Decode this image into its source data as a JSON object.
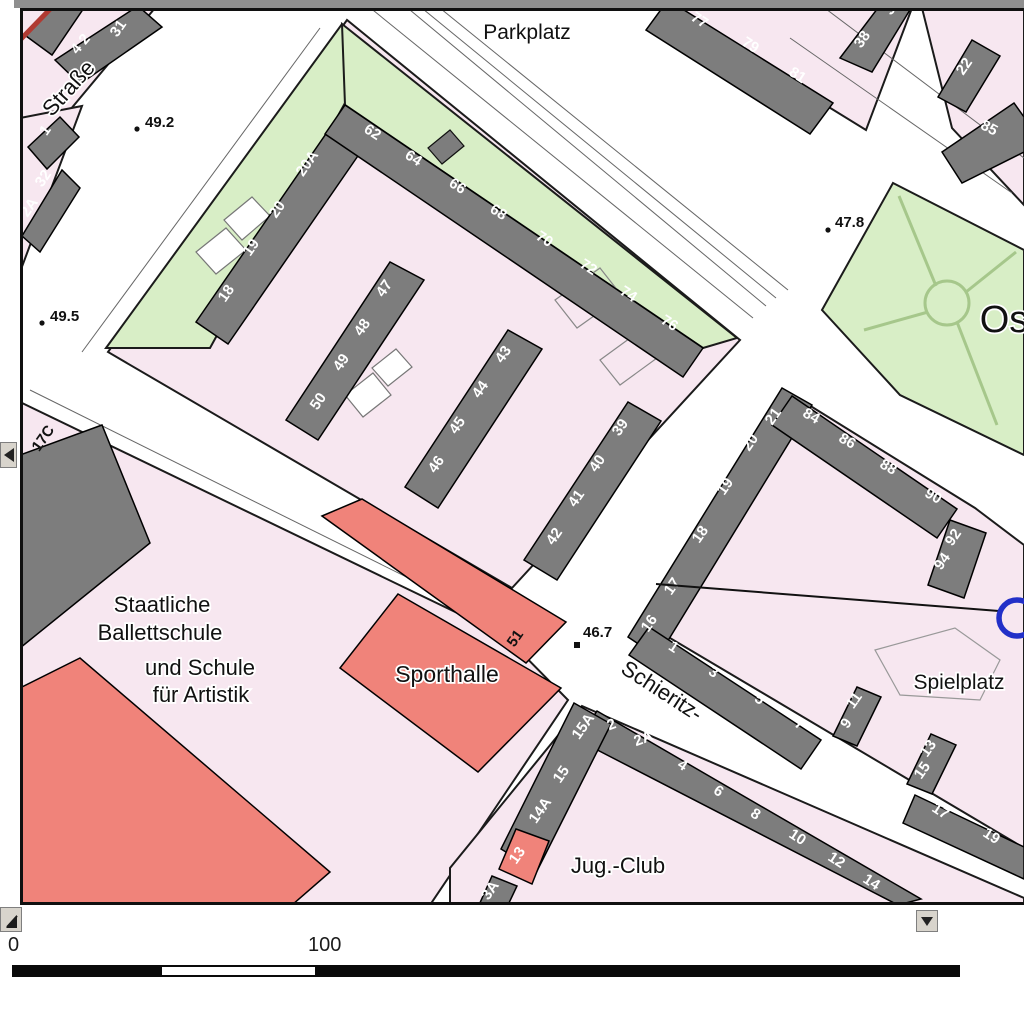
{
  "ui": {
    "scale": {
      "zero": "0",
      "hundred": "100"
    }
  },
  "colors": {
    "pink": "#f7e7f0",
    "green": "#d8eec6",
    "building": "#7d7d7d",
    "red": "#f0837a",
    "outline": "#1b1b1b",
    "park_path": "#a6c78b",
    "street_line": "#666666",
    "label_ink": "#111111",
    "halo": "#ffffff",
    "number_ink": "#ffffff",
    "annotation_blue": "#2230c8",
    "annotation_red": "#b03a32"
  },
  "map": {
    "blocks": [
      {
        "n": "block-topleft-a",
        "f": "pink",
        "p": "20,8 155,8 20,170"
      },
      {
        "n": "block-topleft-b",
        "f": "pink",
        "p": "20,118 82,106 20,272"
      },
      {
        "n": "block-main",
        "f": "pink",
        "p": "108,352 347,20 740,340 512,588"
      },
      {
        "n": "green-northwest",
        "f": "green",
        "p": "106,348 342,24 372,54 210,348"
      },
      {
        "n": "green-northeast",
        "f": "green",
        "p": "342,24 737,338 703,348 345,105"
      },
      {
        "n": "block-topright-a",
        "f": "pink",
        "p": "655,0 915,0 866,130"
      },
      {
        "n": "block-topright-b",
        "f": "pink",
        "p": "920,0 1024,0 1024,205 952,128"
      },
      {
        "n": "park-green",
        "f": "green",
        "p": "893,183 1024,250 1024,455 900,395 822,310"
      },
      {
        "n": "block-school",
        "f": "pink",
        "p": "20,402 505,636 568,700 430,905 20,905"
      },
      {
        "n": "block-spielplatz",
        "f": "pink",
        "p": "643,622 788,392 975,508 1024,545 1024,848"
      },
      {
        "n": "block-south",
        "f": "pink",
        "p": "582,706 1024,898 1024,905 450,905 450,868"
      }
    ],
    "street_lines": [
      {
        "p": [
          363,
          2,
          753,
          318
        ]
      },
      {
        "p": [
          398,
          0,
          766,
          306
        ]
      },
      {
        "p": [
          412,
          0,
          776,
          298
        ]
      },
      {
        "p": [
          430,
          0,
          788,
          290
        ]
      },
      {
        "p": [
          790,
          38,
          1012,
          193
        ]
      },
      {
        "p": [
          822,
          6,
          1024,
          158
        ]
      },
      {
        "p": [
          82,
          352,
          320,
          28
        ]
      },
      {
        "p": [
          30,
          390,
          497,
          622
        ]
      }
    ],
    "courtyards": [
      {
        "p": "196,252 226,228 246,250 216,274",
        "f": "#ffffff",
        "s": "#777777"
      },
      {
        "p": "224,220 252,197 270,216 242,240",
        "f": "#ffffff",
        "s": "#777777"
      },
      {
        "p": "345,395 373,373 391,395 363,417",
        "f": "#ffffff",
        "s": "#777777"
      },
      {
        "p": "372,368 396,349 412,367 388,386",
        "f": "#ffffff",
        "s": "#777777"
      },
      {
        "p": "555,300 600,268 622,296 577,328",
        "f": "none",
        "s": "#888888"
      },
      {
        "p": "600,360 648,325 668,350 620,385",
        "f": "none",
        "s": "#888888"
      },
      {
        "p": "428,148 450,130 464,146 442,164",
        "f": "#7d7d7d",
        "s": "#111111"
      },
      {
        "p": "875,650 955,628 1000,660 980,700 900,695",
        "f": "none",
        "s": "#999999"
      }
    ],
    "park": {
      "circle": {
        "cx": 947,
        "cy": 303,
        "r": 22
      },
      "paths": [
        [
          899,
          196,
          936,
          286
        ],
        [
          1016,
          252,
          966,
          292
        ],
        [
          864,
          330,
          928,
          312
        ],
        [
          997,
          425,
          957,
          322
        ]
      ]
    },
    "buildings_dark": [
      {
        "n": "bld-18-20a",
        "p": "196,322 330,128 362,150 228,344"
      },
      {
        "n": "bld-62-76",
        "p": "345,105 703,348 683,377 325,134"
      },
      {
        "n": "bld-47-50",
        "p": "286,420 390,262 424,280 318,440"
      },
      {
        "n": "bld-43-46",
        "p": "405,487 508,330 542,349 438,508"
      },
      {
        "n": "bld-39-42",
        "p": "524,560 628,402 661,421 557,580"
      },
      {
        "n": "bld-77-81",
        "p": "668,0 833,103 810,134 646,30"
      },
      {
        "n": "bld-38",
        "p": "840,58 884,0 916,0 872,72"
      },
      {
        "n": "bld-22",
        "p": "938,97 972,40 1000,56 966,112"
      },
      {
        "n": "bld-85",
        "p": "942,152 1014,103 1024,117 1024,152 962,183"
      },
      {
        "n": "bld-16-21",
        "p": "628,637 782,388 812,405 658,657"
      },
      {
        "n": "bld-84-90",
        "p": "792,396 957,509 937,538 772,425"
      },
      {
        "n": "bld-92-94",
        "p": "928,585 950,520 986,533 964,598"
      },
      {
        "n": "bld-1-7",
        "p": "649,627 821,740 801,769 629,655"
      },
      {
        "n": "bld-9-11",
        "p": "833,736 857,687 881,697 857,746"
      },
      {
        "n": "bld-13-15",
        "p": "907,784 931,734 956,745 932,794"
      },
      {
        "n": "bld-17-19",
        "p": "915,795 1024,847 1024,879 903,823"
      },
      {
        "n": "bld-2-14",
        "p": "597,711 921,899 898,905 578,740"
      },
      {
        "n": "bld-14a-15a",
        "p": "574,703 611,724 537,871 501,849"
      },
      {
        "n": "bld-3a",
        "p": "479,905 492,876 517,886 508,905"
      },
      {
        "n": "bld-4-2-31",
        "p": "55,60 138,6 162,27 80,84"
      },
      {
        "n": "bld-corner",
        "p": "26,36 56,2 88,2 52,55"
      },
      {
        "n": "bld-1-left",
        "p": "28,147 60,117 79,137 47,169"
      },
      {
        "n": "bld-32-2a",
        "p": "22,236 62,170 80,188 40,252"
      },
      {
        "n": "bld-ballett-slab",
        "p": "20,455 102,425 150,543 20,648"
      }
    ],
    "buildings_red": [
      {
        "n": "bld-sport-band",
        "p": "322,516 362,499 566,622 526,663"
      },
      {
        "n": "bld-sporthalle",
        "p": "398,594 561,688 478,772 340,668"
      },
      {
        "n": "bld-ballett-red",
        "p": "20,688 80,658 330,872 292,905 20,905"
      },
      {
        "n": "bld-13-red",
        "p": "499,869 516,829 549,841 532,884"
      }
    ],
    "house_numbers": [
      {
        "t": "4 2",
        "x": 84,
        "y": 47,
        "r": -50
      },
      {
        "t": "31",
        "x": 122,
        "y": 31,
        "r": -55
      },
      {
        "t": "1",
        "x": 49,
        "y": 133,
        "r": -55
      },
      {
        "t": "32",
        "x": 47,
        "y": 181,
        "r": -55
      },
      {
        "t": "2A",
        "x": 33,
        "y": 210,
        "r": -55
      },
      {
        "t": "18",
        "x": 230,
        "y": 296,
        "r": -55
      },
      {
        "t": "19",
        "x": 255,
        "y": 250,
        "r": -55
      },
      {
        "t": "20",
        "x": 281,
        "y": 212,
        "r": -55
      },
      {
        "t": "20A",
        "x": 311,
        "y": 166,
        "r": -55
      },
      {
        "t": "62",
        "x": 370,
        "y": 136,
        "r": 33
      },
      {
        "t": "64",
        "x": 411,
        "y": 162,
        "r": 33
      },
      {
        "t": "66",
        "x": 455,
        "y": 190,
        "r": 33
      },
      {
        "t": "68",
        "x": 496,
        "y": 216,
        "r": 33
      },
      {
        "t": "70",
        "x": 542,
        "y": 243,
        "r": 33
      },
      {
        "t": "72",
        "x": 586,
        "y": 271,
        "r": 33
      },
      {
        "t": "74",
        "x": 626,
        "y": 298,
        "r": 33
      },
      {
        "t": "76",
        "x": 667,
        "y": 327,
        "r": 33
      },
      {
        "t": "50",
        "x": 322,
        "y": 404,
        "r": -55
      },
      {
        "t": "49",
        "x": 345,
        "y": 365,
        "r": -55
      },
      {
        "t": "48",
        "x": 366,
        "y": 330,
        "r": -55
      },
      {
        "t": "47",
        "x": 388,
        "y": 291,
        "r": -55
      },
      {
        "t": "46",
        "x": 440,
        "y": 467,
        "r": -55
      },
      {
        "t": "45",
        "x": 461,
        "y": 428,
        "r": -55
      },
      {
        "t": "44",
        "x": 484,
        "y": 392,
        "r": -55
      },
      {
        "t": "43",
        "x": 507,
        "y": 357,
        "r": -55
      },
      {
        "t": "42",
        "x": 558,
        "y": 539,
        "r": -55
      },
      {
        "t": "41",
        "x": 580,
        "y": 501,
        "r": -55
      },
      {
        "t": "40",
        "x": 601,
        "y": 466,
        "r": -55
      },
      {
        "t": "39",
        "x": 624,
        "y": 430,
        "r": -55
      },
      {
        "t": "77",
        "x": 697,
        "y": 24,
        "r": 33
      },
      {
        "t": "79",
        "x": 748,
        "y": 49,
        "r": 33
      },
      {
        "t": "81",
        "x": 795,
        "y": 79,
        "r": 33
      },
      {
        "t": "38",
        "x": 866,
        "y": 42,
        "r": -55
      },
      {
        "t": "36",
        "x": 896,
        "y": 9,
        "r": -55
      },
      {
        "t": "22",
        "x": 968,
        "y": 69,
        "r": -55
      },
      {
        "t": "85",
        "x": 987,
        "y": 132,
        "r": 28
      },
      {
        "t": "16",
        "x": 653,
        "y": 626,
        "r": -55
      },
      {
        "t": "17",
        "x": 676,
        "y": 589,
        "r": -55
      },
      {
        "t": "18",
        "x": 704,
        "y": 537,
        "r": -55
      },
      {
        "t": "19",
        "x": 729,
        "y": 489,
        "r": -55
      },
      {
        "t": "20",
        "x": 754,
        "y": 445,
        "r": -55
      },
      {
        "t": "21",
        "x": 777,
        "y": 419,
        "r": -55
      },
      {
        "t": "84",
        "x": 809,
        "y": 420,
        "r": 30
      },
      {
        "t": "86",
        "x": 845,
        "y": 445,
        "r": 30
      },
      {
        "t": "88",
        "x": 886,
        "y": 471,
        "r": 30
      },
      {
        "t": "90",
        "x": 931,
        "y": 500,
        "r": 30
      },
      {
        "t": "92",
        "x": 957,
        "y": 540,
        "r": -55
      },
      {
        "t": "94",
        "x": 946,
        "y": 564,
        "r": -55
      },
      {
        "t": "1",
        "x": 671,
        "y": 651,
        "r": 33
      },
      {
        "t": "3",
        "x": 711,
        "y": 676,
        "r": 33
      },
      {
        "t": "5",
        "x": 757,
        "y": 703,
        "r": 33
      },
      {
        "t": "7",
        "x": 797,
        "y": 728,
        "r": 33
      },
      {
        "t": "11",
        "x": 858,
        "y": 703,
        "r": -55
      },
      {
        "t": "9",
        "x": 850,
        "y": 726,
        "r": -55
      },
      {
        "t": "13",
        "x": 932,
        "y": 751,
        "r": -55
      },
      {
        "t": "15",
        "x": 926,
        "y": 773,
        "r": -55
      },
      {
        "t": "17",
        "x": 938,
        "y": 815,
        "r": 33
      },
      {
        "t": "19",
        "x": 989,
        "y": 840,
        "r": 33
      },
      {
        "t": "2",
        "x": 613,
        "y": 729,
        "r": -20
      },
      {
        "t": "2A",
        "x": 645,
        "y": 743,
        "r": -20
      },
      {
        "t": "4",
        "x": 680,
        "y": 769,
        "r": 33
      },
      {
        "t": "6",
        "x": 716,
        "y": 795,
        "r": 33
      },
      {
        "t": "8",
        "x": 753,
        "y": 818,
        "r": 33
      },
      {
        "t": "10",
        "x": 795,
        "y": 841,
        "r": 33
      },
      {
        "t": "12",
        "x": 834,
        "y": 864,
        "r": 33
      },
      {
        "t": "14",
        "x": 869,
        "y": 886,
        "r": 33
      },
      {
        "t": "15A",
        "x": 587,
        "y": 729,
        "r": -55
      },
      {
        "t": "15",
        "x": 565,
        "y": 777,
        "r": -55
      },
      {
        "t": "14A",
        "x": 544,
        "y": 813,
        "r": -55
      },
      {
        "t": "13",
        "x": 521,
        "y": 858,
        "r": -55
      },
      {
        "t": "3A",
        "x": 494,
        "y": 893,
        "r": -55
      },
      {
        "t": "51",
        "x": 519,
        "y": 641,
        "r": -55,
        "c": "#111111"
      },
      {
        "t": "17C",
        "x": 47,
        "y": 441,
        "r": -55,
        "c": "#111111"
      }
    ],
    "labels": [
      {
        "t": "Parkplatz",
        "x": 527,
        "y": 39,
        "s": 21
      },
      {
        "t": "Straße",
        "x": 74,
        "y": 93,
        "s": 22,
        "r": -48
      },
      {
        "t": "Os",
        "x": 1004,
        "y": 332,
        "s": 38
      },
      {
        "t": "Schieritz-",
        "x": 658,
        "y": 697,
        "s": 22,
        "r": 33
      },
      {
        "t": "Spielplatz",
        "x": 959,
        "y": 689,
        "s": 21
      },
      {
        "t": "Jug.-Club",
        "x": 618,
        "y": 873,
        "s": 22
      },
      {
        "t": "Sporthalle",
        "x": 447,
        "y": 682,
        "s": 23
      },
      {
        "t": "Staatliche",
        "x": 162,
        "y": 612,
        "s": 22
      },
      {
        "t": "Ballettschule",
        "x": 160,
        "y": 640,
        "s": 22
      },
      {
        "t": "und Schule",
        "x": 200,
        "y": 675,
        "s": 22
      },
      {
        "t": "für Artistik",
        "x": 201,
        "y": 702,
        "s": 22
      }
    ],
    "elevations": [
      {
        "t": "49.2",
        "x": 145,
        "y": 127,
        "dx": 137,
        "dy": 129,
        "m": "dot"
      },
      {
        "t": "49.5",
        "x": 50,
        "y": 321,
        "dx": 42,
        "dy": 323,
        "m": "dot"
      },
      {
        "t": "47.8",
        "x": 835,
        "y": 227,
        "dx": 828,
        "dy": 230,
        "m": "dot"
      },
      {
        "t": "46.7",
        "x": 583,
        "y": 637,
        "dx": 577,
        "dy": 645,
        "m": "sq"
      }
    ],
    "annotations": {
      "pointer_line": {
        "x1": 656,
        "y1": 584,
        "x2": 999,
        "y2": 611
      },
      "highlight_circle": {
        "cx": 1017,
        "cy": 618,
        "r": 18
      },
      "red_mark": {
        "x1": 21,
        "y1": 39,
        "x2": 57,
        "y2": 2
      }
    }
  }
}
